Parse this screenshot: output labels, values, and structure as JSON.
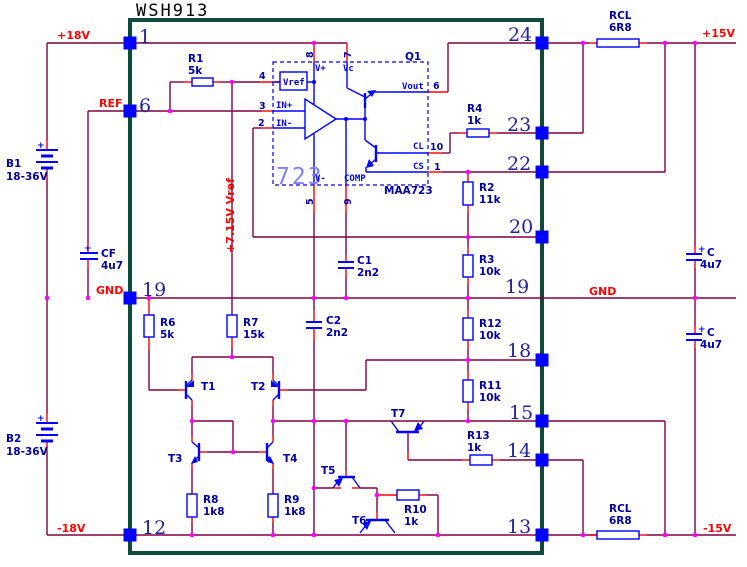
{
  "title": "WSH913",
  "colors": {
    "wire": "#800040",
    "lead": "#ff0000",
    "symbol": "#0000ff",
    "border_green": "#0f4a3c",
    "junction_dot": "#ff00ff",
    "component_label": "#0000a0",
    "net_label": "#ff0000",
    "pin_number": "#22229a",
    "ic_symbol_text": "#8080ff"
  },
  "nets": {
    "p18v": "+18V",
    "ref": "REF",
    "gnd_left": "GND",
    "m18v": "-18V",
    "p15v": "+15V",
    "m15v": "-15V",
    "gnd_right": "GND",
    "vref_rail": "+7.15V Vref"
  },
  "pin_numbers": {
    "n1": "1",
    "n6": "6",
    "n19_left": "19",
    "n12": "12",
    "n24": "24",
    "n23": "23",
    "n22": "22",
    "n20": "20",
    "n19_right": "19",
    "n18": "18",
    "n15": "15",
    "n14": "14",
    "n13": "13"
  },
  "ic723": {
    "designator": "Q1",
    "symbol_text": "723",
    "part_number": "MAA723",
    "labels": {
      "vplus": "V+",
      "vc": "Vc",
      "vref": "Vref",
      "in_plus": "IN+",
      "in_minus": "IN-",
      "vminus": "V-",
      "comp": "COMP",
      "vout": "Vout",
      "cl": "CL",
      "cs": "CS"
    },
    "pads": {
      "p8": "8",
      "p7": "7",
      "p4": "4",
      "p3": "3",
      "p2": "2",
      "p5": "5",
      "p9": "9",
      "p6": "6",
      "p10": "10",
      "p1": "1"
    }
  },
  "resistors": {
    "r1": {
      "name": "R1",
      "value": "5k"
    },
    "r2": {
      "name": "R2",
      "value": "11k"
    },
    "r3": {
      "name": "R3",
      "value": "10k"
    },
    "r4": {
      "name": "R4",
      "value": "1k"
    },
    "r6": {
      "name": "R6",
      "value": "5k"
    },
    "r7": {
      "name": "R7",
      "value": "15k"
    },
    "r8": {
      "name": "R8",
      "value": "1k8"
    },
    "r9": {
      "name": "R9",
      "value": "1k8"
    },
    "r10": {
      "name": "R10",
      "value": "1k"
    },
    "r11": {
      "name": "R11",
      "value": "10k"
    },
    "r12": {
      "name": "R12",
      "value": "10k"
    },
    "r13": {
      "name": "R13",
      "value": "1k"
    },
    "rcl_top": {
      "name": "RCL",
      "value": "6R8"
    },
    "rcl_bottom": {
      "name": "RCL",
      "value": "6R8"
    }
  },
  "capacitors": {
    "c1": {
      "name": "C1",
      "value": "2n2"
    },
    "c2": {
      "name": "C2",
      "value": "2n2"
    },
    "cf": {
      "name": "CF",
      "value": "4u7",
      "polarity": "+"
    },
    "c_right_top": {
      "name": "C",
      "value": "4u7",
      "polarity": "+"
    },
    "c_right_bottom": {
      "name": "C",
      "value": "4u7",
      "polarity": "+"
    }
  },
  "batteries": {
    "b1": {
      "name": "B1",
      "value": "18-36V",
      "polarity": "+"
    },
    "b2": {
      "name": "B2",
      "value": "18-36V",
      "polarity": "+"
    }
  },
  "transistors": {
    "t1": "T1",
    "t2": "T2",
    "t3": "T3",
    "t4": "T4",
    "t5": "T5",
    "t6": "T6",
    "t7": "T7"
  }
}
